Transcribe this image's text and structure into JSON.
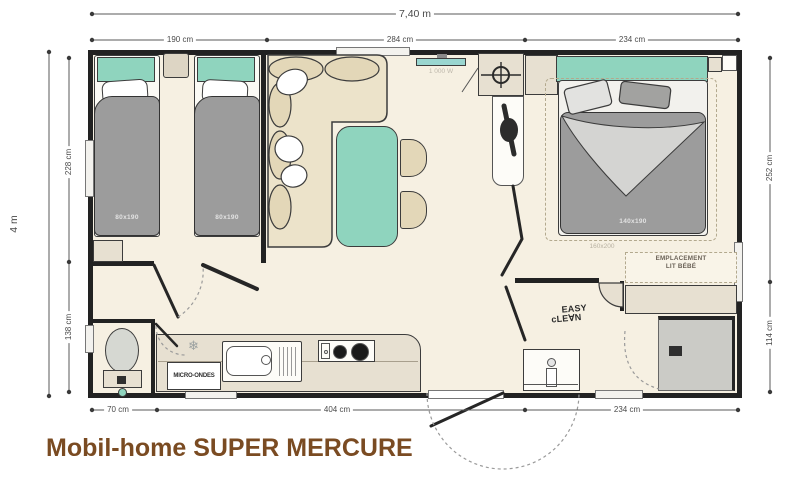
{
  "title": "Mobil-home SUPER MERCURE",
  "dimensions": {
    "overall_width": "7,40 m",
    "overall_height": "4 m",
    "top": [
      "190 cm",
      "284 cm",
      "234 cm"
    ],
    "left": [
      "228 cm",
      "138 cm"
    ],
    "right": [
      "252 cm",
      "114 cm"
    ],
    "bottom": [
      "70 cm",
      "404 cm",
      "234 cm"
    ]
  },
  "labels": {
    "bed1": "80x190",
    "bed2": "80x190",
    "master_bed": "140x190",
    "master_bed_option": "160x200",
    "baby_bed_line1": "EMPLACEMENT",
    "baby_bed_line2": "LIT BÉBÉ",
    "microwave": "MICRO-ONDES",
    "heater_power": "1 000 W",
    "logo_line1": "EASY",
    "logo_line2": "cLE∀N"
  },
  "icons": {
    "snowflake": "❄"
  },
  "colors": {
    "accent_teal": "#8fd4be",
    "furniture_beige": "#e7e0d1",
    "interior_cream": "#f6f0e2",
    "wall_black": "#222222",
    "duvet_gray": "#9c9c9c",
    "title_brown": "#7a4b22"
  }
}
